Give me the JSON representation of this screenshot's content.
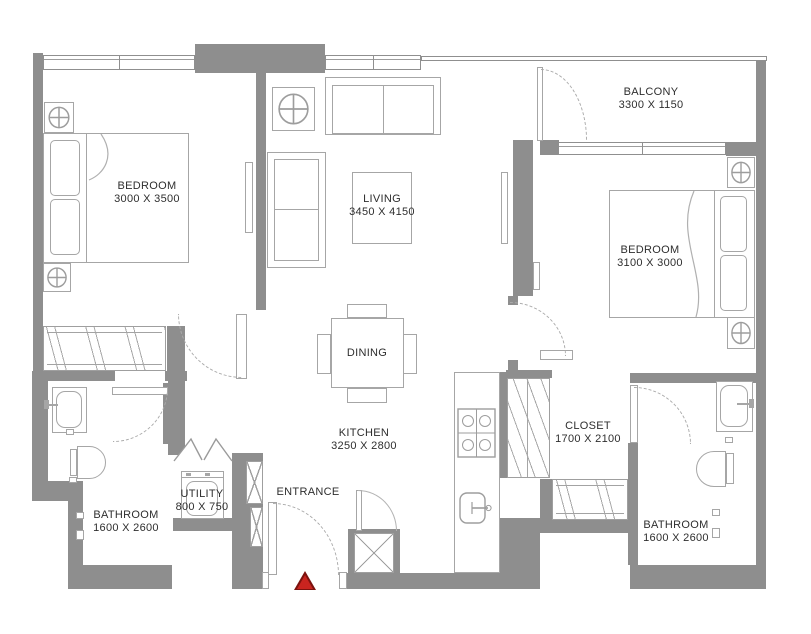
{
  "colors": {
    "wall": "#8e8e8e",
    "furniture-line": "#a6a6a6",
    "text": "#2e2e2e",
    "marker-fill": "#c9241f",
    "marker-border": "#7c120e"
  },
  "rooms": {
    "bedroom1": {
      "name": "BEDROOM",
      "dims": "3000 X 3500"
    },
    "living": {
      "name": "LIVING",
      "dims": "3450 X 4150"
    },
    "balcony": {
      "name": "BALCONY",
      "dims": "3300 X 1150"
    },
    "bedroom2": {
      "name": "BEDROOM",
      "dims": "3100 X 3000"
    },
    "dining": {
      "name": "DINING"
    },
    "kitchen": {
      "name": "KITCHEN",
      "dims": "3250 X 2800"
    },
    "closet": {
      "name": "CLOSET",
      "dims": "1700 X 2100"
    },
    "bathroom1": {
      "name": "BATHROOM",
      "dims": "1600 X 2600"
    },
    "utility": {
      "name": "UTILITY",
      "dims": "800 X 750"
    },
    "entrance": {
      "name": "ENTRANCE"
    },
    "bathroom2": {
      "name": "BATHROOM",
      "dims": "1600 X 2600"
    }
  }
}
